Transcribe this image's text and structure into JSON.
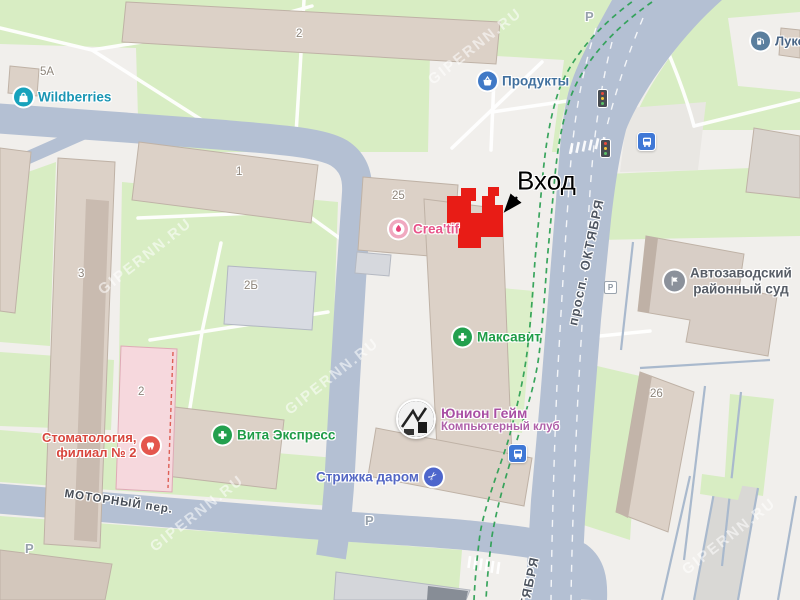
{
  "watermark": "GIPERNN.RU",
  "colors": {
    "road": "#b4c0d3",
    "greenery": "#d8edc3",
    "building": "#dcd1c7",
    "target_highlight": "#e81c16",
    "route_dash": "#2fa156"
  },
  "streets": {
    "oktyabrya": "просп. ОКТЯБРЯ",
    "oktyabrya_bottom": "ОКТЯБРЯ",
    "motorny": "МОТОРНЫЙ пер."
  },
  "buildings": {
    "b2_top": "2",
    "b5a": "5А",
    "b1": "1",
    "b3": "3",
    "b2b": "2Б",
    "b25": "25",
    "b2_pink": "2",
    "b26": "26"
  },
  "parking": {
    "p_top": "Р",
    "p_mid": "Р",
    "p_bottom": "Р",
    "p_court": "Р"
  },
  "entrance": {
    "label": "Вход"
  },
  "pois": {
    "wildberries": {
      "label": "Wildberries",
      "icon": "bag-icon",
      "color": "#1a96b4"
    },
    "produkty": {
      "label": "Продукты",
      "icon": "basket-icon",
      "color": "#41709e"
    },
    "lukoil": {
      "label": "Лукойл",
      "icon": "fuel-icon",
      "color": "#4a6585"
    },
    "creatif": {
      "label": "Crea'tif",
      "icon": "beauty-icon",
      "color": "#e8548a"
    },
    "maksavit": {
      "label": "Максавит",
      "icon": "pharmacy-cross-icon",
      "color": "#1f9c47"
    },
    "vita_express": {
      "label": "Вита Экспресс",
      "icon": "pharmacy-cross-icon",
      "color": "#1f9c47"
    },
    "stomatologia": {
      "label_line1": "Стоматология,",
      "label_line2": "филиал № 2",
      "icon": "tooth-icon",
      "color": "#d8463d"
    },
    "strizhka": {
      "label": "Стрижка даром",
      "icon": "scissors-icon",
      "color": "#5366c4"
    },
    "union_game": {
      "label": "Юнион Гейм",
      "sublabel": "Компьютерный клуб",
      "icon": "photo-logo",
      "color": "#a94fa4"
    },
    "court": {
      "label_line1": "Автозаводский",
      "label_line2": "районный суд",
      "icon": "flag-icon",
      "color": "#575d66"
    }
  }
}
